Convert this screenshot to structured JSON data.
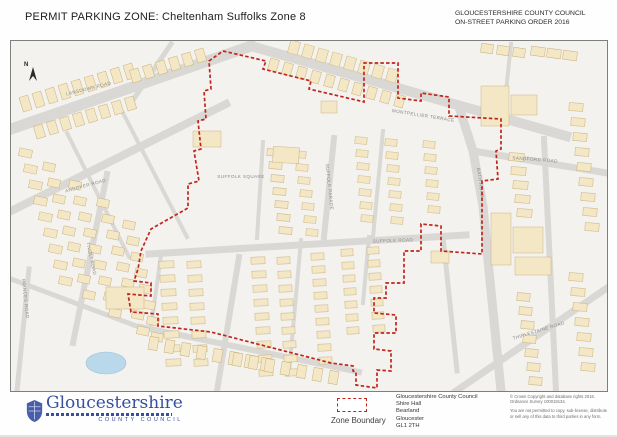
{
  "header": {
    "title_left": "PERMIT PARKING ZONE:  Cheltenham Suffolks Zone 8",
    "title_right_line1": "GLOUCESTERSHIRE COUNTY COUNCIL",
    "title_right_line2": "ON-STREET PARKING ORDER 2016"
  },
  "map": {
    "north_label": "N",
    "streets": [
      {
        "label": "LANSDOWN ROAD",
        "x": 78,
        "y": 49,
        "rot": -14
      },
      {
        "label": "MONTPELLIER TERRACE",
        "x": 412,
        "y": 76,
        "rot": 9
      },
      {
        "label": "SANDFORD ROAD",
        "x": 524,
        "y": 120,
        "rot": 4
      },
      {
        "label": "ANDOVER ROAD",
        "x": 75,
        "y": 146,
        "rot": -15
      },
      {
        "label": "SUFFOLK ROAD",
        "x": 382,
        "y": 201,
        "rot": -2
      },
      {
        "label": "SUFFOLK PARADE",
        "x": 317,
        "y": 146,
        "rot": 84
      },
      {
        "label": "SUFFOLK SQUARE",
        "x": 230,
        "y": 137,
        "rot": 0
      },
      {
        "label": "BATH ROAD",
        "x": 468,
        "y": 142,
        "rot": 82
      },
      {
        "label": "TIVOLI ROAD",
        "x": 79,
        "y": 218,
        "rot": 78
      },
      {
        "label": "PRINCES ROAD",
        "x": 13,
        "y": 258,
        "rot": 84
      },
      {
        "label": "THIRLESTAINE ROAD",
        "x": 528,
        "y": 291,
        "rot": -17
      }
    ],
    "boundary_points": "212,10 255,20 252,28 300,40 298,48 345,59 353,61 353,22 387,22 387,57 410,60 410,52 438,56 438,75 490,78 490,108 485,110 487,138 471,140 471,213 430,210 430,185 410,183 410,210 393,210 393,242 375,242 375,257 363,257 363,272 385,274 385,292 363,292 363,308 380,310 380,330 366,329 366,347 345,344 345,331 342,330 342,325 320,322 200,291 147,285 147,273 120,271 117,253 140,255 140,242 123,240 127,228 130,210 140,188 177,167 177,143 188,140 183,110 190,108 187,80 195,78 193,50 200,48 198,20 212,10",
    "colors": {
      "boundary": "#c0261c",
      "road": "#d9d8d5",
      "building": "#f3e7c5",
      "building_outline": "#c9b27e",
      "water": "#b9d8e9",
      "background": "#f4f2ee"
    }
  },
  "legend": {
    "zone_boundary_label": "Zone Boundary"
  },
  "footer": {
    "logo": {
      "name": "Gloucestershire",
      "subtitle": "COUNTY COUNCIL"
    },
    "address_lines": [
      "Gloucestershire County Council",
      "Shire Hall",
      "Bearland",
      "Gloucester",
      "GL1 2TH"
    ],
    "copyright_lines": [
      "© Crown Copyright and database rights 2016.",
      "Ordnance Survey 100019134."
    ],
    "disclaimer": "You are not permitted to copy, sub-license, distribute or sell any of this data to third parties in any form."
  }
}
